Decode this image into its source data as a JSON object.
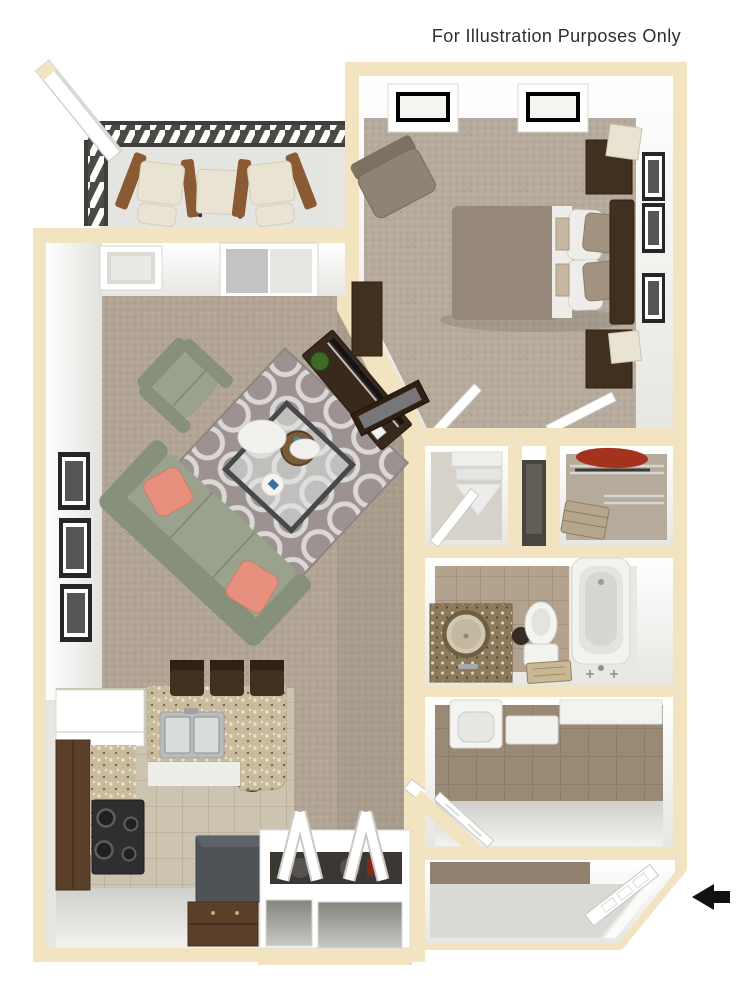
{
  "disclaimer": "For Illustration Purposes Only",
  "entry_arrow": {
    "name": "entry-arrow",
    "direction": "left",
    "color": "#111111"
  },
  "colors": {
    "text": "#2e2e2e",
    "trim": "#f2e4c1",
    "wall-shade": "#e7e6e3",
    "carpet": "#b2a596",
    "carpet-dark": "#93816f",
    "carpet-bedroom": "#b6aa9c",
    "rug-base": "#9c9391",
    "rug-line": "#dbd7d4",
    "sofa": "#9aa28e",
    "sofa-dark": "#87907b",
    "pillow-coral": "#e8907e",
    "wood-dark": "#41301f",
    "wood-med": "#5a3f2b",
    "chair-taupe": "#8e8374",
    "comforter": "#95877a",
    "sheets": "#efedea",
    "pillow-tan": "#a29380",
    "granite-kitchen": "#c9bc9e",
    "granite-vanity": "#8d7a5c",
    "stove": "#2e2f30",
    "steel": "#b9bcbd",
    "tile-kitchen": "#ccc3b0",
    "tile-bath": "#b2a28e",
    "tile-laundry": "#998a76",
    "balcony-floor": "#e4e4e1",
    "entry-floor": "#d9d9d6",
    "railing": "#4b4a47",
    "frame-black": "#262626",
    "photo": "#565656",
    "arrow": "#111111",
    "cushion-cream": "#e9e4d1",
    "wood-patio": "#8a5a33",
    "red-closet": "#a5321c",
    "fridge": "#4e5357"
  }
}
